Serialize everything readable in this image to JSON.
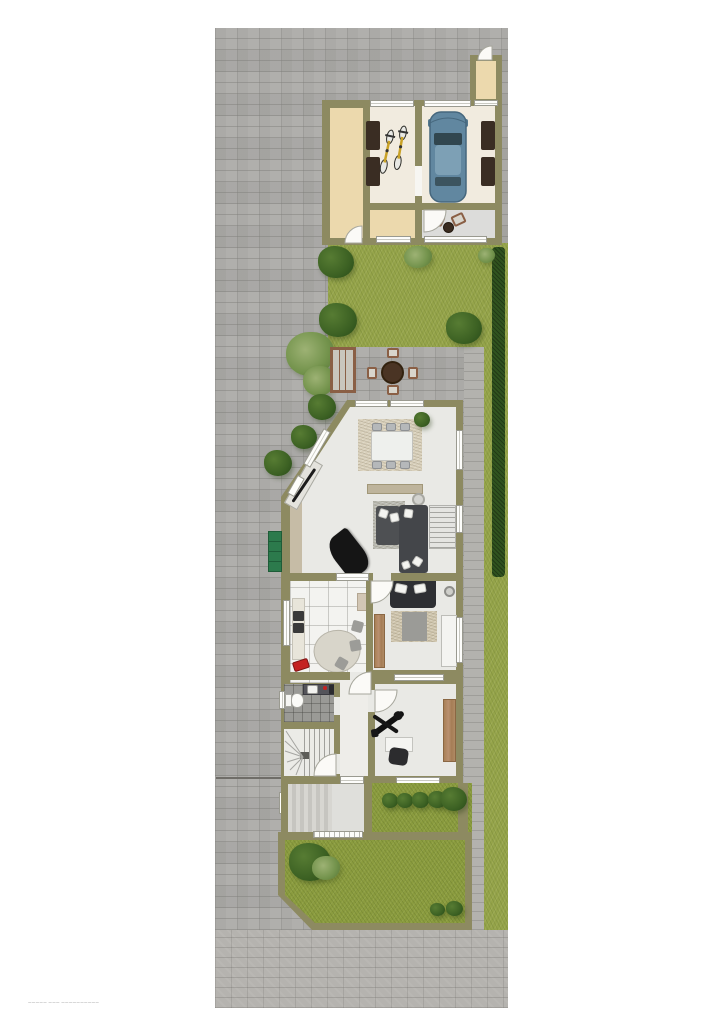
{
  "footer": {
    "note": "————— ——— ——————————"
  },
  "colors": {
    "background": "#ffffff",
    "paving": "#abaaa7",
    "street": "#b5b3af",
    "wall": "#8d8a61",
    "lawn": "#95a44a",
    "lawn_dark": "#8b9c3f",
    "hedge": "#30531f",
    "bush": "#3c6123",
    "floor_cream": "#f1ebdf",
    "floor_beige": "#ecd9ad",
    "floor_house": "#e9e9e5",
    "kitchen_tile": "#f3f3f0",
    "bath_tile": "#9a9a96",
    "patio": "#dcdcda",
    "car_body": "#6187a0",
    "dark_mat": "#3a2d23",
    "sofa": "#45474b",
    "rug": "#cfc6ae",
    "wood": "#b08a64",
    "piano": "#151515",
    "garden_bench": "#2c7a4c",
    "terrace_table": "#4a3424",
    "accent_red": "#c42222"
  },
  "areas": [
    "paved-driveway",
    "street",
    "garage",
    "bicycle-room",
    "storage-room",
    "garage-side-room",
    "garage-patio",
    "front-lawn",
    "terrace",
    "hedge",
    "living-room",
    "dining-area",
    "kitchen",
    "bedroom",
    "bathroom",
    "staircase",
    "hallway",
    "office",
    "entry-deck",
    "back-garden"
  ],
  "furniture": [
    "car",
    "bicycles",
    "dining-table",
    "dining-chairs",
    "sideboard",
    "sofa",
    "grand-piano",
    "coffee-table",
    "terrace-table",
    "terrace-chairs",
    "terrace-bench",
    "garden-table-set",
    "bed",
    "nightstands",
    "wardrobe",
    "desk",
    "desk-chair",
    "exercise-machine",
    "kitchen-island",
    "cooktop",
    "toilet",
    "vanity",
    "display-cabinet",
    "outdoor-bench"
  ]
}
